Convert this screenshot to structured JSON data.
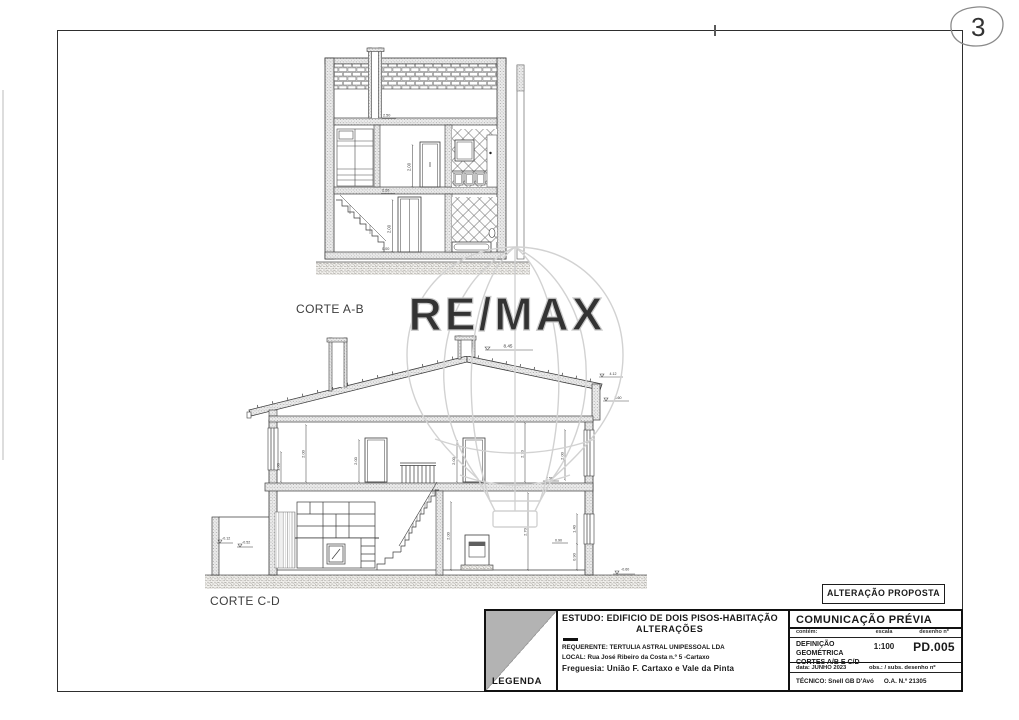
{
  "page": {
    "sheet_number": "3"
  },
  "watermark": {
    "brand": "RE/MAX"
  },
  "drawings": {
    "corteAB": {
      "label": "CORTE A-B",
      "dims": {
        "door_upper": "2.00",
        "door_lower": "2.00",
        "ceiling_level": "2.50",
        "floor_level": "2.20",
        "ground_level": "0.00"
      }
    },
    "corteCD": {
      "label": "CORTE C-D",
      "dims": {
        "ridge": "8.45",
        "eave_upper": "4.12",
        "eave_lower": "3.60",
        "sill_left": "1.00",
        "wall_left": "2.00",
        "door_left": "2.00",
        "door_right": "2.00",
        "room_upper_right": "2.70",
        "window_right": "2.00",
        "floor_level_right": "2.56",
        "kitchen_height": "2.00",
        "room_lower_right": "2.70",
        "window_lower": "1.40",
        "sill_lower": "0.90",
        "sill_level": "0.90",
        "grade_right": "-0.60",
        "grade_left_a": "-0.12",
        "grade_left_b": "-0.52"
      }
    }
  },
  "stamp": {
    "label": "ALTERAÇÃO PROPOSTA"
  },
  "title_block": {
    "legend_label": "LEGENDA",
    "estudo_line1": "ESTUDO: EDIFICIO DE DOIS PISOS-HABITAÇÃO",
    "estudo_line2": "ALTERAÇÕES",
    "requerente": "REQUERENTE: TERTULIA ASTRAL UNIPESSOAL LDA",
    "local": "LOCAL: Rua José Ribeiro da Costa n.º 5  -Cartaxo",
    "freguesia": "Freguesia: União F. Cartaxo e Vale da Pinta",
    "right": {
      "title": "COMUNICAÇÃO PRÉVIA",
      "header_contem": "contém:",
      "header_escala": "escala",
      "header_desenho": "desenho nº",
      "contem_line1": "DEFINIÇÃO GEOMÉTRICA",
      "contem_line2": "CORTES  A/B E C/D",
      "escala_value": "1:100",
      "desenho_value": "PD.005",
      "data_row": "data: JUNHO 2023",
      "obs_row": "obs.: / subs. desenho nº",
      "tecnico": "TÉCNICO: Snell GB D'Avó",
      "ordem": "O.A. N.º 21305"
    }
  }
}
